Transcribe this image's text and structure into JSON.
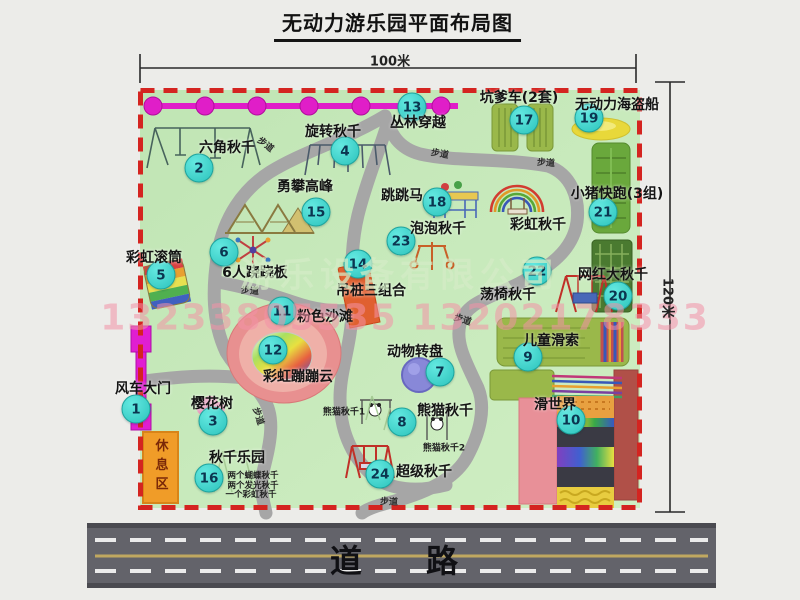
{
  "title": "无动力游乐园平面布局图",
  "dimensions": {
    "width_label": "100米",
    "height_label": "120米"
  },
  "road_label": "道路",
  "path_label": "步道",
  "watermark": {
    "company": "游乐设备有限公司",
    "phone": "13233805535 13202178333"
  },
  "colors": {
    "map_green": "#c5e8ba",
    "border_red": "#d42420",
    "badge_cyan": "#2ec4bd",
    "chain_magenta": "#e01ec8",
    "rest_orange": "#f09c28",
    "road_gray": "#63636a"
  },
  "map": {
    "items": [
      {
        "num": "1",
        "label": "风车大门"
      },
      {
        "num": "2",
        "label": "六角秋千"
      },
      {
        "num": "3",
        "label": "樱花树"
      },
      {
        "num": "4",
        "label": "旋转秋千"
      },
      {
        "num": "5",
        "label": "彩虹滚筒"
      },
      {
        "num": "6",
        "label": "6人跷跷板"
      },
      {
        "num": "7",
        "label": "动物转盘"
      },
      {
        "num": "8",
        "label": "熊猫秋千"
      },
      {
        "num": "9",
        "label": "儿童滑索"
      },
      {
        "num": "10",
        "label": "滑世界"
      },
      {
        "num": "11",
        "label": "粉色沙滩"
      },
      {
        "num": "12",
        "label": "彩虹蹦蹦云"
      },
      {
        "num": "13",
        "label": "丛林穿越"
      },
      {
        "num": "14",
        "label": "吊桩三组合"
      },
      {
        "num": "15",
        "label": "勇攀高峰"
      },
      {
        "num": "16",
        "label": "秋千乐园"
      },
      {
        "num": "17",
        "label": "坑爹车(2套)"
      },
      {
        "num": "18",
        "label": "跳跳马"
      },
      {
        "num": "19",
        "label": "无动力海盗船"
      },
      {
        "num": "20",
        "label": "网红大秋千"
      },
      {
        "num": "21",
        "label": "小猪快跑(3组)"
      },
      {
        "num": "22",
        "label": "荡椅秋千"
      },
      {
        "num": "23",
        "label": "泡泡秋千"
      },
      {
        "num": "24",
        "label": "超级秋千"
      }
    ],
    "extras": {
      "rainbow_swing": "彩虹秋千",
      "rest_area": "休息区",
      "panda1": "熊猫秋千1",
      "panda2": "熊猫秋千2",
      "swing_notes": [
        "两个蝴蝶秋千",
        "两个发光秋千",
        "一个彩虹秋千"
      ]
    }
  }
}
